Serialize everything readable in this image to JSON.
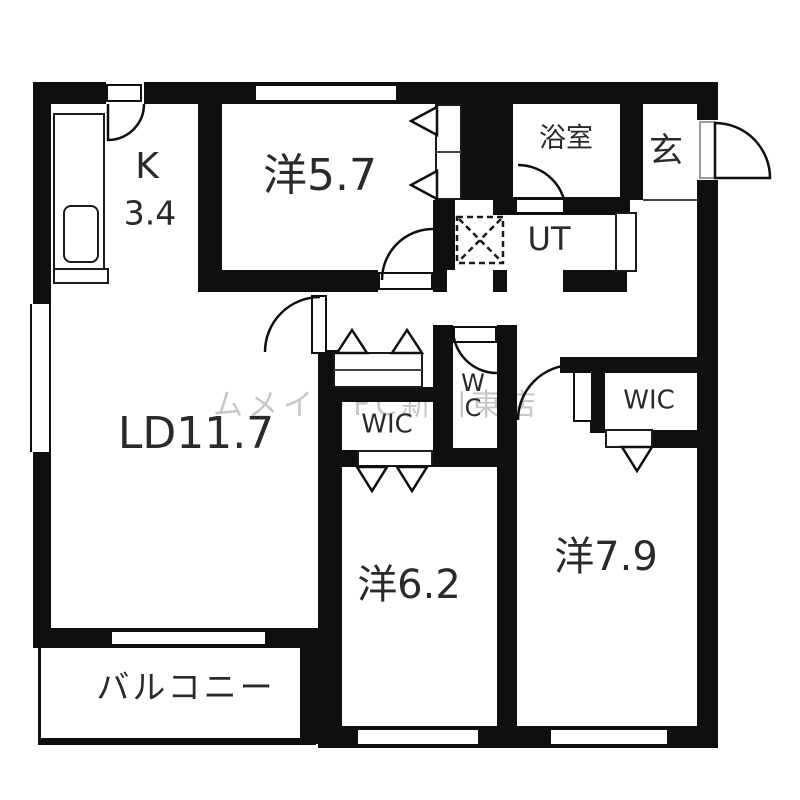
{
  "floorplan": {
    "title": "apartment-floor-plan",
    "rooms": {
      "kitchen": {
        "label_line1": "K",
        "label_line2": "3.4"
      },
      "bedroom_57": {
        "label": "洋5.7"
      },
      "bath": {
        "label": "浴室"
      },
      "entrance": {
        "label": "玄"
      },
      "utility": {
        "label": "UT"
      },
      "living_dining": {
        "label": "LD11.7"
      },
      "wic_1": {
        "label": "WIC"
      },
      "wc": {
        "label_line1": "W",
        "label_line2": "C"
      },
      "wic_2": {
        "label": "WIC"
      },
      "bedroom_62": {
        "label": "洋6.2"
      },
      "bedroom_79": {
        "label": "洋7.9"
      },
      "balcony": {
        "label": "バルコニー"
      }
    },
    "watermark": "ムメイトFC新川東店",
    "features": [
      "kitchen-counter",
      "kitchen-sink",
      "washing-machine-pan",
      "shoe-cabinet",
      "closet-bifold-doors",
      "door-swings",
      "windows"
    ],
    "colors": {
      "wall": "#0f0f0f",
      "background": "#ffffff",
      "label": "#2a2a2a",
      "watermark": "#9a9a9a"
    }
  }
}
